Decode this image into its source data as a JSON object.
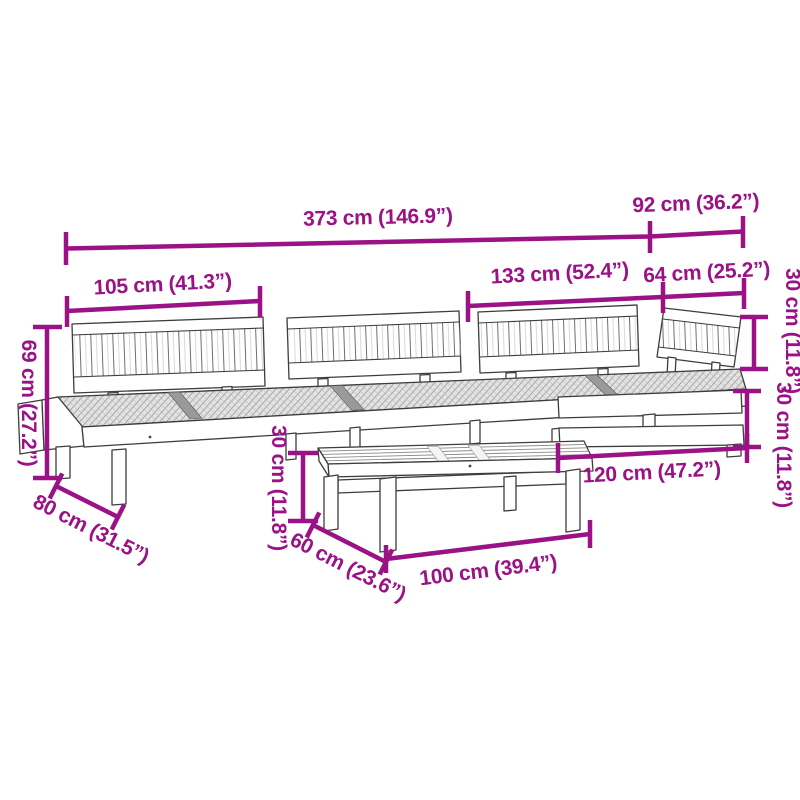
{
  "diagram": {
    "title": "pallet-sofa-set-dimension-diagram",
    "background_color": "#ffffff",
    "accent_color": "#9A1285",
    "line_art_color": "#3d3d3d",
    "objects": [
      "left-sofa-backrest",
      "middle-sofa-backrest",
      "wide-sofa-backrest",
      "corner-sofa-backrest",
      "pallet-seat-platform",
      "coffee-table"
    ],
    "dimensions": [
      {
        "id": "overall-width",
        "label": "373 cm (146.9”)",
        "orientation": "horizontal"
      },
      {
        "id": "right-section-width",
        "label": "92 cm (36.2”)",
        "orientation": "horizontal"
      },
      {
        "id": "left-backrest-width",
        "label": "105 cm (41.3”)",
        "orientation": "horizontal"
      },
      {
        "id": "wide-backrest-width",
        "label": "133 cm (52.4”)",
        "orientation": "horizontal"
      },
      {
        "id": "corner-backrest-width",
        "label": "64 cm (25.2”)",
        "orientation": "horizontal"
      },
      {
        "id": "backrest-height",
        "label": "30 cm (11.8”)",
        "orientation": "vertical"
      },
      {
        "id": "seat-height",
        "label": "30 cm (11.8”)",
        "orientation": "vertical"
      },
      {
        "id": "corner-seat-width",
        "label": "120 cm (47.2”)",
        "orientation": "horizontal"
      },
      {
        "id": "total-height",
        "label": "69 cm (27.2”)",
        "orientation": "vertical"
      },
      {
        "id": "sofa-depth",
        "label": "80 cm (31.5”)",
        "orientation": "diagonal"
      },
      {
        "id": "table-height",
        "label": "30 cm (11.8”)",
        "orientation": "vertical"
      },
      {
        "id": "table-depth",
        "label": "60 cm (23.6”)",
        "orientation": "diagonal"
      },
      {
        "id": "table-width",
        "label": "100 cm (39.4”)",
        "orientation": "horizontal"
      }
    ]
  }
}
